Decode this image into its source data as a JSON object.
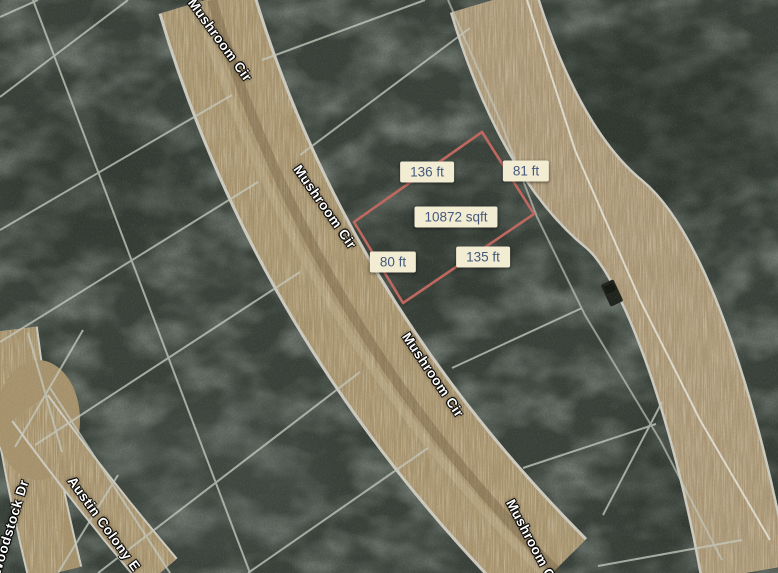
{
  "map": {
    "view_type": "satellite",
    "parcel": {
      "area_label": "10872 sqft",
      "edge_top": "136 ft",
      "edge_right": "81 ft",
      "edge_bottom": "135 ft",
      "edge_left": "80 ft",
      "outline_color": "#c0685f"
    },
    "streets": {
      "mushroom_1": "Mushroom Cir",
      "mushroom_2": "Mushroom Cir",
      "mushroom_3": "Mushroom Cir",
      "mushroom_4": "Mushroom Cir",
      "woodstock": "Woodstock Dr",
      "austin_colony": "Austin Colony E"
    },
    "colors": {
      "measure_label_bg": "#f2ecd3",
      "measure_label_text": "#44587b",
      "parcel_outline": "#c0685f",
      "forest": "#39413a",
      "dirt_road": "#a8946e",
      "lot_line": "#c6cabf",
      "street_label_text": "#ffffff"
    }
  }
}
